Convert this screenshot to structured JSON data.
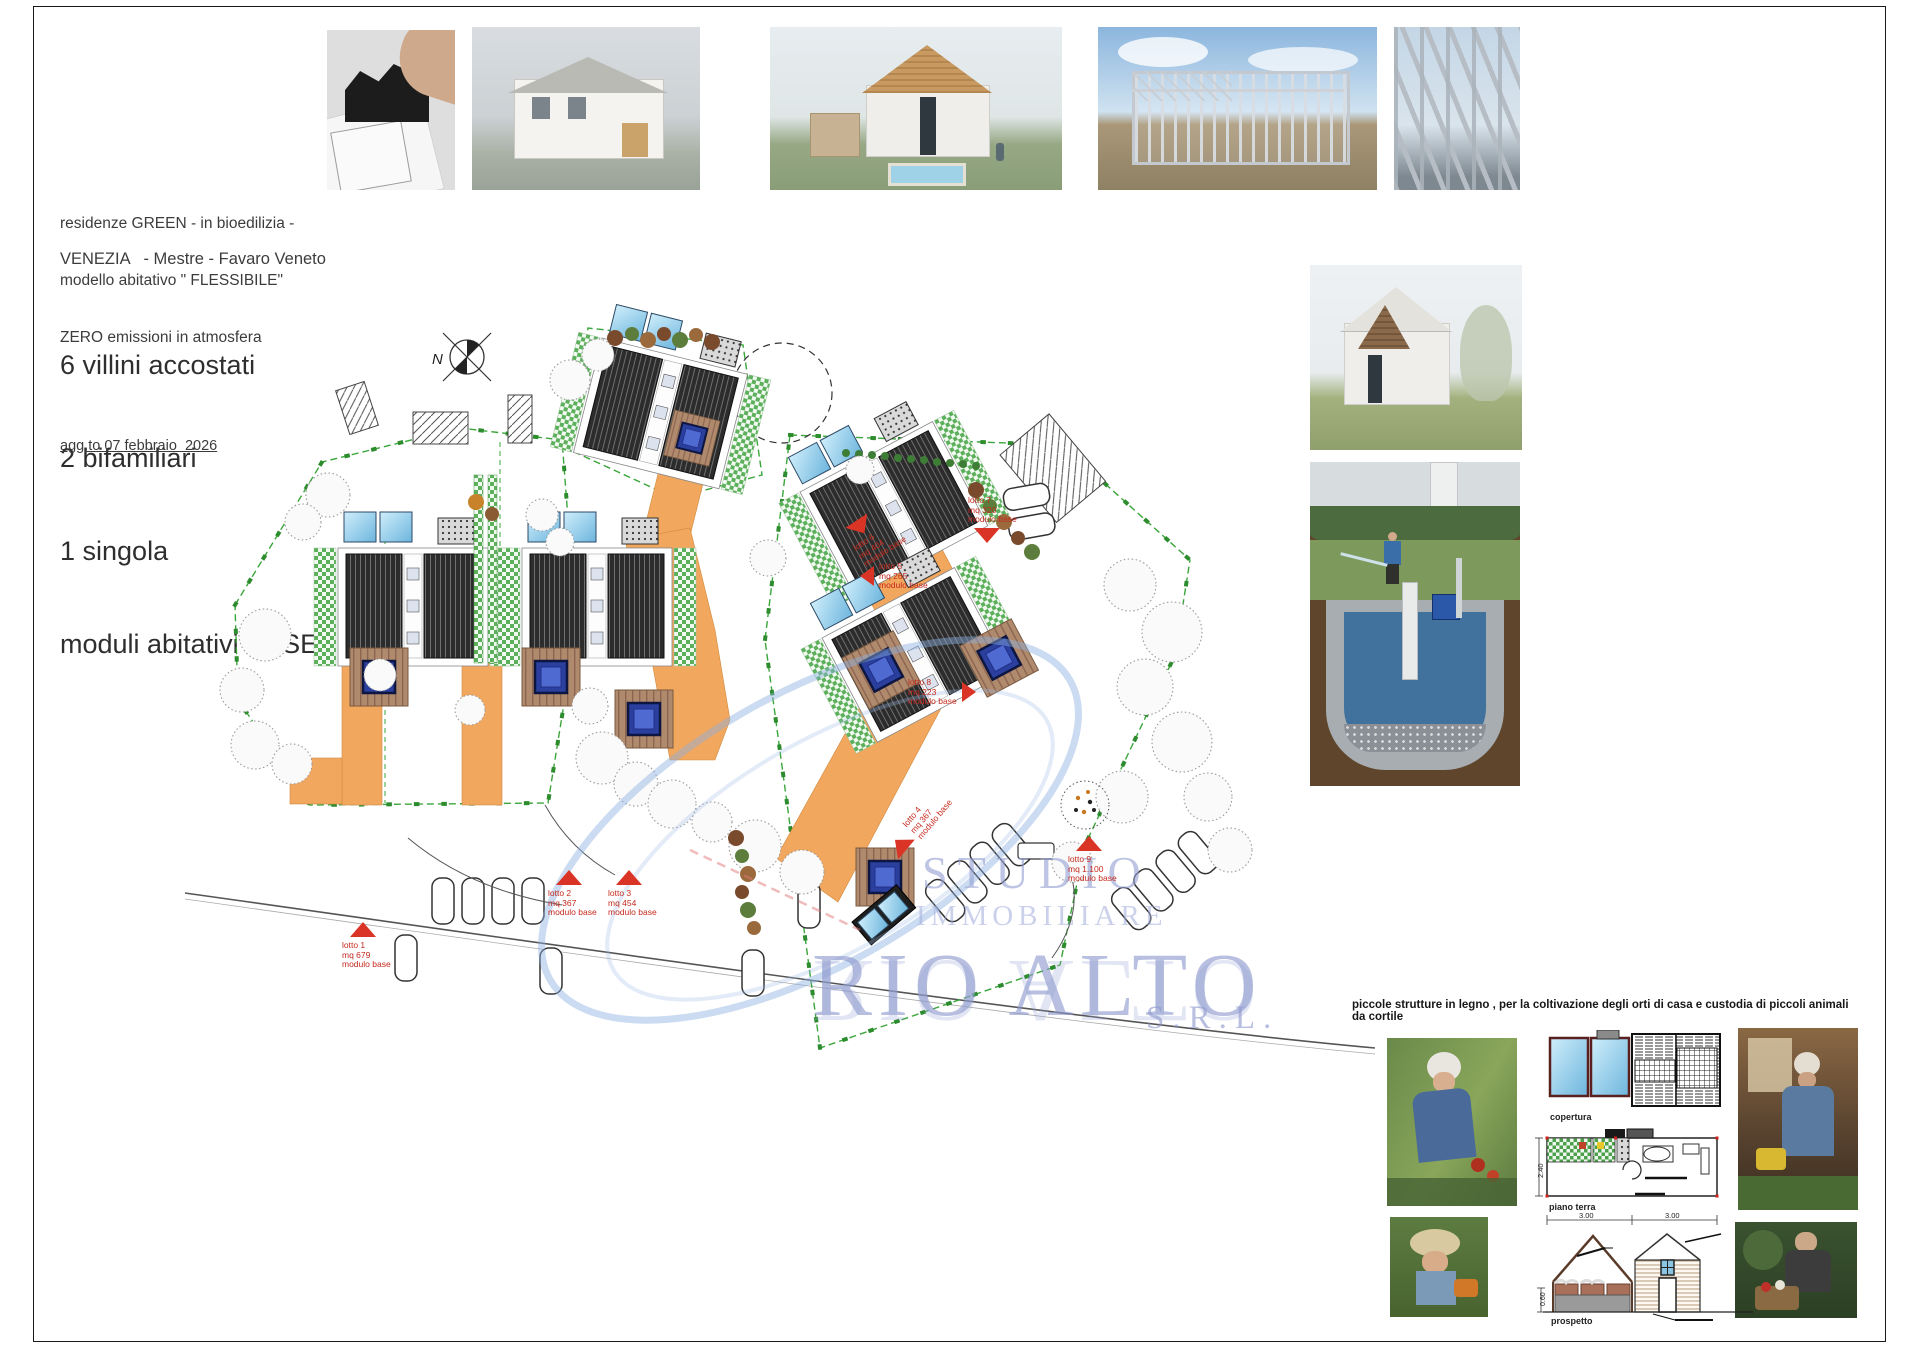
{
  "colors": {
    "marker_red": "#d93425",
    "boundary_green": "#3aa53a",
    "path_orange": "#f2a75e",
    "watermark_blue": "#9aa6d6"
  },
  "info": {
    "line1": "residenze GREEN - in bioedilizia -",
    "line2": "modello abitativo \" FLESSIBILE\"",
    "line3": "ZERO emissioni in atmosfera",
    "location": "VENEZIA   - Mestre - Favaro Veneto",
    "count1": "6 villini accostati",
    "count2": "2 bifamiliari",
    "count3": "1 singola",
    "count4": "moduli abitativi BASE",
    "updated": "agg.to 07 febbraio  2026"
  },
  "plan": {
    "north": "N",
    "lots": [
      {
        "id": "lotto 1",
        "area": "mq 679",
        "module": "modulo base"
      },
      {
        "id": "lotto 2",
        "area": "mq 367",
        "module": "modulo base"
      },
      {
        "id": "lotto 3",
        "area": "mq  454",
        "module": "modulo base"
      },
      {
        "id": "lotto 4",
        "area": "mq 367",
        "module": "modulo base"
      },
      {
        "id": "lotto 5",
        "area": "mq 265",
        "module": "modulo base"
      },
      {
        "id": "lotto 6",
        "area": "mq  404",
        "module": "modulo base"
      },
      {
        "id": "lotto 7",
        "area": "mq 320",
        "module": "modulo base"
      },
      {
        "id": "lotto 8",
        "area": "mq 223",
        "module": "modulo base"
      },
      {
        "id": "lotto 9",
        "area": "mq 1.100",
        "module": "modulo base"
      }
    ]
  },
  "watermark": {
    "studio": "STUDIO",
    "immobiliare": "IMMOBILIARE",
    "rio_alto": "RIO ALTO",
    "srl": "S.R.L."
  },
  "footer": {
    "caption": "piccole strutture in legno , per la coltivazione degli orti di casa e custodia di piccoli animali da cortile",
    "labels": {
      "roof_plan": "copertura",
      "ground_floor": "piano terra",
      "elevation": "prospetto"
    },
    "dims": {
      "w1": "3.00",
      "w2": "3.00",
      "h": "2.40",
      "h2": "0.60"
    }
  }
}
